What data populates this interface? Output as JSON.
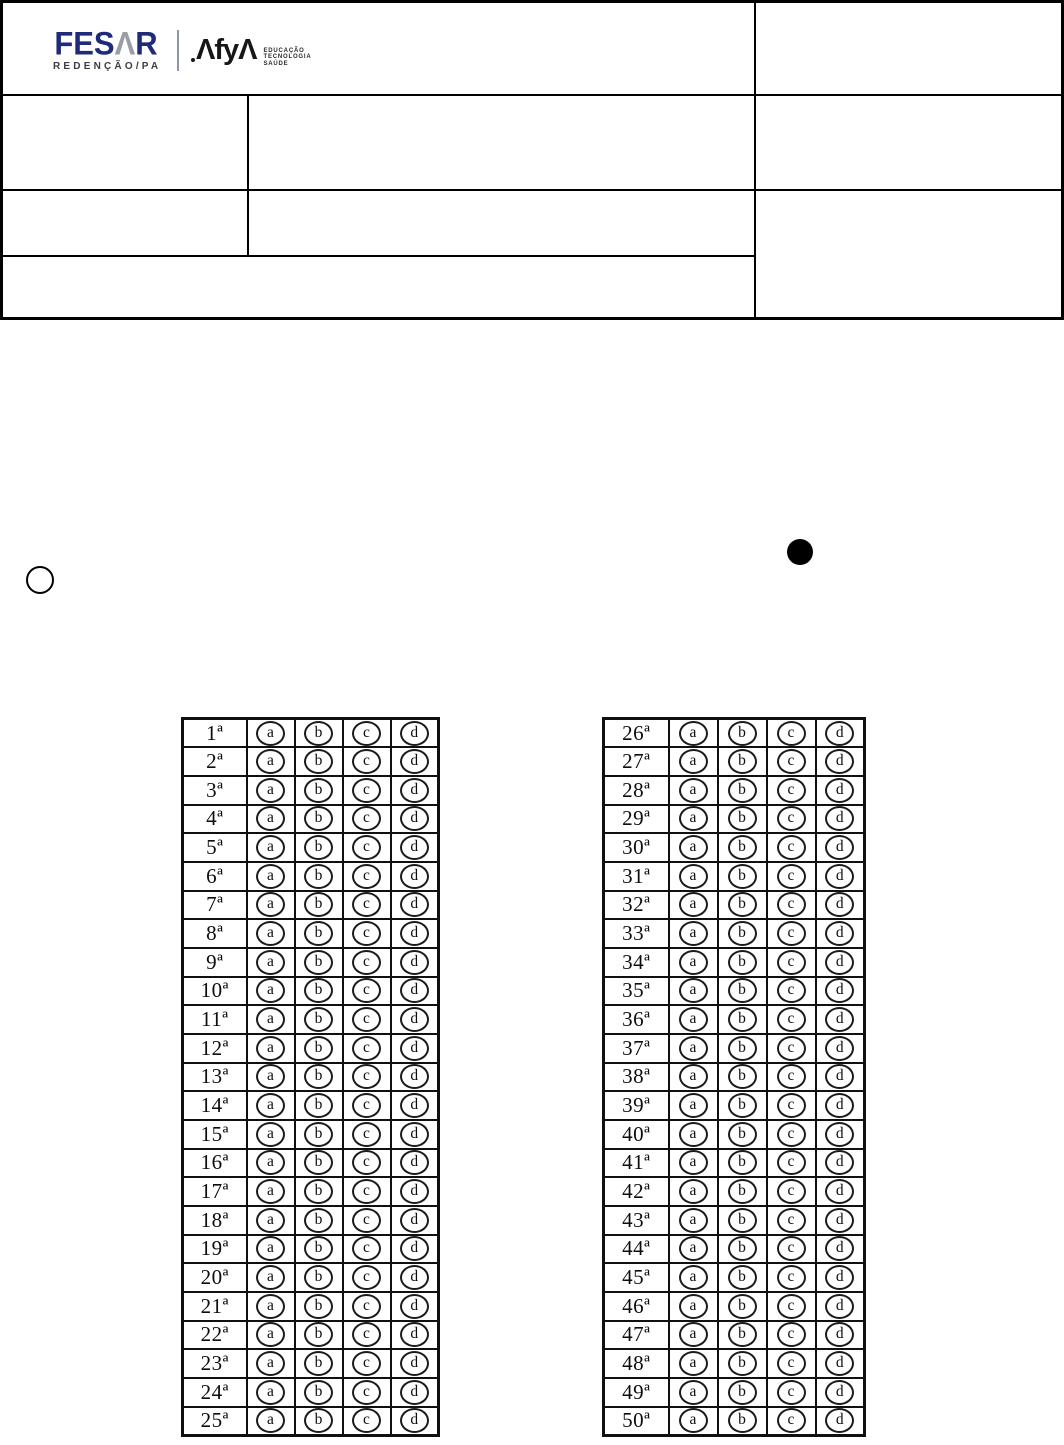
{
  "header": {
    "fesar": {
      "brand": "FESAR",
      "wordmark_prefix": "FES",
      "wordmark_a": "Λ",
      "wordmark_suffix": "R",
      "subtitle": "REDENÇÃO/PA"
    },
    "afya": {
      "brand": "Afya",
      "mark_first": "Λ",
      "mark_mid": "fy",
      "mark_last": "Λ",
      "tagline": [
        "EDUCAÇÃO",
        "TECNOLOGIA",
        "SAÚDE"
      ]
    }
  },
  "colors": {
    "fesar_navy": "#1f2a78",
    "fesar_gray": "#9a9da3",
    "ink": "#101010",
    "background": "#ffffff"
  },
  "answer_grids": {
    "options": [
      "a",
      "b",
      "c",
      "d"
    ],
    "left_rows": [
      "1ª",
      "2ª",
      "3ª",
      "4ª",
      "5ª",
      "6ª",
      "7ª",
      "8ª",
      "9ª",
      "10ª",
      "11ª",
      "12ª",
      "13ª",
      "14ª",
      "15ª",
      "16ª",
      "17ª",
      "18ª",
      "19ª",
      "20ª",
      "21ª",
      "22ª",
      "23ª",
      "24ª",
      "25ª"
    ],
    "right_rows": [
      "26ª",
      "27ª",
      "28ª",
      "29ª",
      "30ª",
      "31ª",
      "32ª",
      "33ª",
      "34ª",
      "35ª",
      "36ª",
      "37ª",
      "38ª",
      "39ª",
      "40ª",
      "41ª",
      "42ª",
      "43ª",
      "44ª",
      "45ª",
      "46ª",
      "47ª",
      "48ª",
      "49ª",
      "50ª"
    ]
  }
}
